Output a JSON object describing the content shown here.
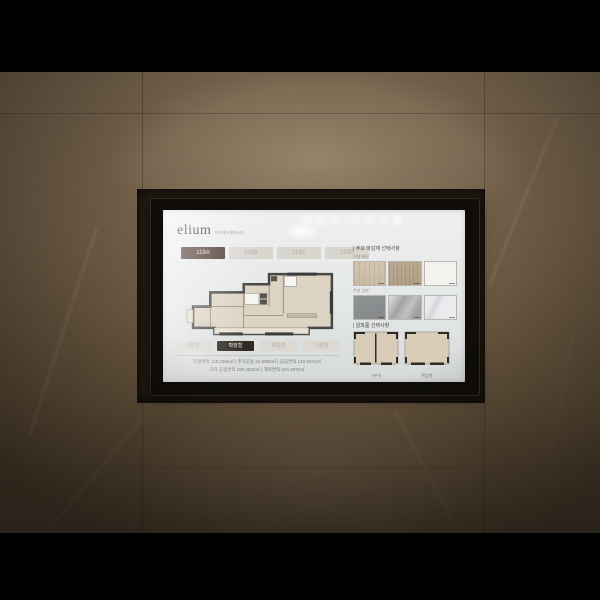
{
  "scene": {
    "sign": {
      "text": "OTHER UNITS"
    }
  },
  "screen": {
    "reflection_text": "풀스퍼크 가람배",
    "header": {
      "logo_text": "elium",
      "tagline": "부산에코델타시티"
    },
    "unit_tabs": [
      {
        "label": "119A",
        "selected": true
      },
      {
        "label": "119B",
        "selected": false
      },
      {
        "label": "119C",
        "selected": false
      },
      {
        "label": "119D",
        "selected": false
      }
    ],
    "floor_plan": {
      "watermark": "elium"
    },
    "plan_type_buttons": [
      {
        "label": "기본형",
        "selected": false
      },
      {
        "label": "확장형",
        "selected": true
      },
      {
        "label": "복층형",
        "selected": false
      },
      {
        "label": "다락형",
        "selected": false
      }
    ],
    "area_info": {
      "line1": "전용면적 119.2368㎡  |  주거공용 24.6893㎡  |  공급면적 143.9341㎡",
      "line2": "기타 공용면적 100.4532㎡  |  계약면적 244.3872㎡"
    },
    "options_panel": {
      "finish_header": "| 주요 마감재 선택사항",
      "finish_groups": [
        {
          "label": "거실 바닥",
          "swatches": [
            {
              "name": "light-wood",
              "color": "#cfc3ae"
            },
            {
              "name": "medium-wood",
              "color": "#b4a38c"
            },
            {
              "name": "white",
              "color": "#f3f2ef"
            }
          ]
        },
        {
          "label": "주방 상판",
          "swatches": [
            {
              "name": "dark-gray",
              "color": "#8a8d8e"
            },
            {
              "name": "gray-marble",
              "color": "#a2a2a5"
            },
            {
              "name": "white-marble",
              "color": "#ebebee"
            }
          ]
        }
      ],
      "layout_header": "| 알파룸 선택사항",
      "layout_options": [
        {
          "label": "기본형"
        },
        {
          "label": "확장형"
        }
      ]
    },
    "accent_colors": {
      "tab_active": "#4c372e",
      "button_active": "#322b25"
    }
  }
}
